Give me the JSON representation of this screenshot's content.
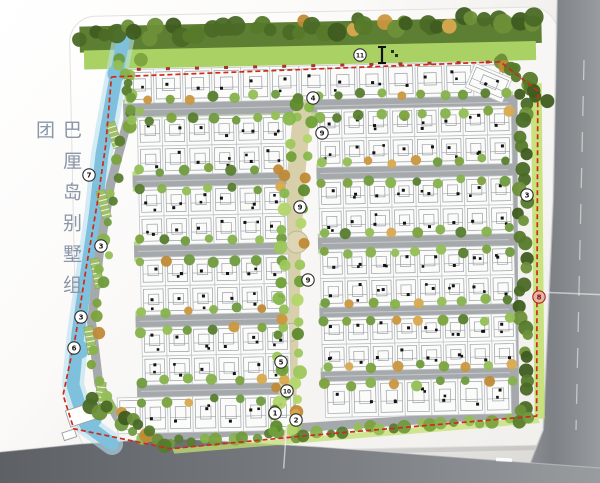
{
  "title": {
    "text": "巴厘岛别墅组团"
  },
  "colors": {
    "road_outer_dark": "#5d6166",
    "road_outer_mid": "#7d8186",
    "road_outer_light": "#989c9f",
    "road_inner": "#a6a9ac",
    "road_line": "#cfd1d2",
    "sheet": "#fdfdfb",
    "sheet_edge": "#e3e1dd",
    "band_dark": "#5d7f33",
    "strip_green": "#a9d164",
    "frame_green": "#c3e070",
    "verge": "#b7d788",
    "lot_fill": "#fbfbfa",
    "lot_line": "#c2c6ca",
    "roof_line": "#9aa0a6",
    "lot_dot": "#131313",
    "boundary_red": "#cf2a1a",
    "tick_red": "#a8362a",
    "lake_blue": "#7fc1dd",
    "lake_blue_light": "#b7dff0",
    "spine_path": "#d8cfab",
    "plaza": "#ddd5b4",
    "marker_fill": "#ffffff",
    "marker_stroke": "#2c2c2c",
    "marker_text": "#141414",
    "marker_accent_fill": "#e9b2a6",
    "marker_accent_stroke": "#a82818",
    "marker_accent_text": "#7e1408",
    "tree_dark": [
      "#3f5c20",
      "#567a2a",
      "#6d9038",
      "#4a6a26"
    ],
    "tree_mix": [
      "#6f9b3e",
      "#86b24c",
      "#577d2e",
      "#94bf55",
      "#7ba23d"
    ],
    "tree_vivid": [
      "#86b84a",
      "#9cc85a",
      "#6fa036",
      "#b3d56b",
      "#5d8a2c"
    ],
    "tree_orange": [
      "#c9973f",
      "#d8a94e",
      "#bf8a35"
    ]
  },
  "markers": [
    {
      "label": "11",
      "x": 360,
      "y": 55
    },
    {
      "label": "4",
      "x": 313,
      "y": 98
    },
    {
      "label": "9",
      "x": 322,
      "y": 133
    },
    {
      "label": "9",
      "x": 300,
      "y": 207
    },
    {
      "label": "9",
      "x": 308,
      "y": 280
    },
    {
      "label": "3",
      "x": 527,
      "y": 195
    },
    {
      "label": "8",
      "x": 539,
      "y": 297,
      "accent": true
    },
    {
      "label": "5",
      "x": 281,
      "y": 362
    },
    {
      "label": "10",
      "x": 287,
      "y": 391
    },
    {
      "label": "1",
      "x": 275,
      "y": 413
    },
    {
      "label": "2",
      "x": 296,
      "y": 420
    },
    {
      "label": "7",
      "x": 89,
      "y": 175
    },
    {
      "label": "3",
      "x": 101,
      "y": 246
    },
    {
      "label": "3",
      "x": 81,
      "y": 317
    },
    {
      "label": "6",
      "x": 74,
      "y": 348
    }
  ],
  "plan": {
    "rotation": -1.2,
    "cx": 300,
    "cy": 245,
    "sheet": {
      "x": 74,
      "y": 12,
      "w": 488,
      "h": 438,
      "r": 26
    },
    "blocks": [
      {
        "x": 128,
        "y": 66,
        "w": 378,
        "h": 34,
        "rows": 1,
        "lots": 13,
        "ticks": true
      },
      {
        "x": 140,
        "y": 114,
        "w": 148,
        "h": 58,
        "rows": 2,
        "lots": 6
      },
      {
        "x": 140,
        "y": 184,
        "w": 148,
        "h": 58,
        "rows": 2,
        "lots": 6
      },
      {
        "x": 140,
        "y": 254,
        "w": 148,
        "h": 58,
        "rows": 2,
        "lots": 6
      },
      {
        "x": 140,
        "y": 324,
        "w": 148,
        "h": 58,
        "rows": 2,
        "lots": 6
      },
      {
        "x": 114,
        "y": 394,
        "w": 176,
        "h": 36,
        "rows": 1,
        "lots": 7
      },
      {
        "x": 320,
        "y": 110,
        "w": 194,
        "h": 58,
        "rows": 2,
        "lots": 8
      },
      {
        "x": 320,
        "y": 180,
        "w": 194,
        "h": 58,
        "rows": 2,
        "lots": 8
      },
      {
        "x": 320,
        "y": 250,
        "w": 194,
        "h": 58,
        "rows": 2,
        "lots": 8
      },
      {
        "x": 320,
        "y": 318,
        "w": 194,
        "h": 54,
        "rows": 2,
        "lots": 8
      },
      {
        "x": 322,
        "y": 382,
        "w": 186,
        "h": 36,
        "rows": 1,
        "lots": 7
      }
    ],
    "streets": [
      {
        "x": 126,
        "y": 100,
        "w": 390,
        "h": 13,
        "main": true
      },
      {
        "x": 134,
        "y": 172,
        "w": 154,
        "h": 12
      },
      {
        "x": 134,
        "y": 242,
        "w": 154,
        "h": 12
      },
      {
        "x": 134,
        "y": 312,
        "w": 154,
        "h": 12
      },
      {
        "x": 134,
        "y": 382,
        "w": 154,
        "h": 12
      },
      {
        "x": 318,
        "y": 168,
        "w": 196,
        "h": 12
      },
      {
        "x": 318,
        "y": 238,
        "w": 196,
        "h": 12
      },
      {
        "x": 318,
        "y": 308,
        "w": 196,
        "h": 11
      },
      {
        "x": 318,
        "y": 372,
        "w": 196,
        "h": 10
      }
    ],
    "vroads": [
      [
        [
          134,
          104
        ],
        [
          112,
          180
        ],
        [
          99,
          250
        ],
        [
          90,
          318
        ],
        [
          96,
          380
        ],
        [
          114,
          414
        ],
        [
          148,
          434
        ]
      ],
      [
        [
          516,
          104
        ],
        [
          513,
          260
        ],
        [
          511,
          420
        ]
      ],
      [
        [
          148,
          434
        ],
        [
          290,
          428
        ],
        [
          509,
          418
        ]
      ],
      [
        [
          283,
          398
        ],
        [
          281,
          434
        ]
      ]
    ],
    "spine": {
      "pts": [
        [
          306,
          104
        ],
        [
          297,
          180
        ],
        [
          292,
          250
        ],
        [
          288,
          330
        ],
        [
          284,
          400
        ],
        [
          281,
          432
        ]
      ],
      "width": 18,
      "plazas": [
        [
          297,
          242,
          11
        ],
        [
          289,
          332,
          9
        ],
        [
          285,
          400,
          8
        ]
      ]
    },
    "lake": [
      [
        128,
        34
      ],
      [
        116,
        90
      ],
      [
        104,
        150
      ],
      [
        96,
        210
      ],
      [
        86,
        270
      ],
      [
        76,
        330
      ],
      [
        70,
        380
      ],
      [
        82,
        420
      ],
      [
        108,
        440
      ]
    ],
    "boundary": [
      [
        115,
        73
      ],
      [
        504,
        66
      ],
      [
        541,
        96
      ],
      [
        536,
        295
      ],
      [
        533,
        421
      ],
      [
        300,
        436
      ],
      [
        166,
        446
      ],
      [
        70,
        424
      ],
      [
        60,
        390
      ],
      [
        74,
        330
      ],
      [
        86,
        262
      ],
      [
        98,
        200
      ],
      [
        108,
        140
      ],
      [
        115,
        73
      ]
    ],
    "belts": [
      {
        "pts": [
          [
            88,
            30
          ],
          [
            542,
            24
          ]
        ],
        "n": 44,
        "rmin": 6,
        "rmax": 10,
        "pal": "tree_dark",
        "jit": 7
      },
      {
        "pts": [
          [
            505,
            60
          ],
          [
            545,
            105
          ]
        ],
        "n": 12,
        "rmin": 5,
        "rmax": 8,
        "pal": "tree_dark",
        "jit": 6
      },
      {
        "pts": [
          [
            525,
            95
          ],
          [
            521,
            420
          ]
        ],
        "n": 30,
        "rmin": 5,
        "rmax": 8,
        "pal": "tree_dark",
        "jit": 5
      },
      {
        "pts": [
          [
            140,
            60
          ],
          [
            122,
            150
          ],
          [
            108,
            230
          ],
          [
            97,
            300
          ],
          [
            92,
            360
          ],
          [
            105,
            410
          ],
          [
            140,
            438
          ]
        ],
        "n": 26,
        "rmin": 4,
        "rmax": 7,
        "pal": "tree_mix",
        "jit": 5
      },
      {
        "pts": [
          [
            165,
            441
          ],
          [
            528,
            422
          ]
        ],
        "n": 30,
        "rmin": 4,
        "rmax": 7,
        "pal": "tree_mix",
        "jit": 4
      },
      {
        "pts": [
          [
            85,
            395
          ],
          [
            160,
            442
          ]
        ],
        "n": 12,
        "rmin": 5,
        "rmax": 8,
        "pal": "tree_dark",
        "jit": 6
      },
      {
        "pts": [
          [
            120,
            58
          ],
          [
            140,
            110
          ]
        ],
        "n": 8,
        "rmin": 4,
        "rmax": 6,
        "pal": "tree_mix",
        "jit": 4
      }
    ],
    "parking": [
      {
        "x": 112,
        "y": 118,
        "w": 9,
        "h": 26,
        "rot": -16
      },
      {
        "x": 100,
        "y": 186,
        "w": 9,
        "h": 28,
        "rot": -13
      },
      {
        "x": 92,
        "y": 254,
        "w": 9,
        "h": 30,
        "rot": -10
      },
      {
        "x": 84,
        "y": 322,
        "w": 9,
        "h": 28,
        "rot": -8
      },
      {
        "x": 93,
        "y": 378,
        "w": 9,
        "h": 22,
        "rot": 8
      }
    ],
    "gatehouse": [
      {
        "x": 62,
        "y": 406,
        "w": 34,
        "h": 17,
        "rot": -17
      },
      {
        "x": 58,
        "y": 428,
        "w": 13,
        "h": 8,
        "rot": -17
      }
    ],
    "axes": [
      [
        536,
        297,
        600,
        301
      ],
      [
        283,
        424,
        279,
        468
      ]
    ],
    "scale_icon": {
      "x": 382,
      "y": 47
    }
  }
}
